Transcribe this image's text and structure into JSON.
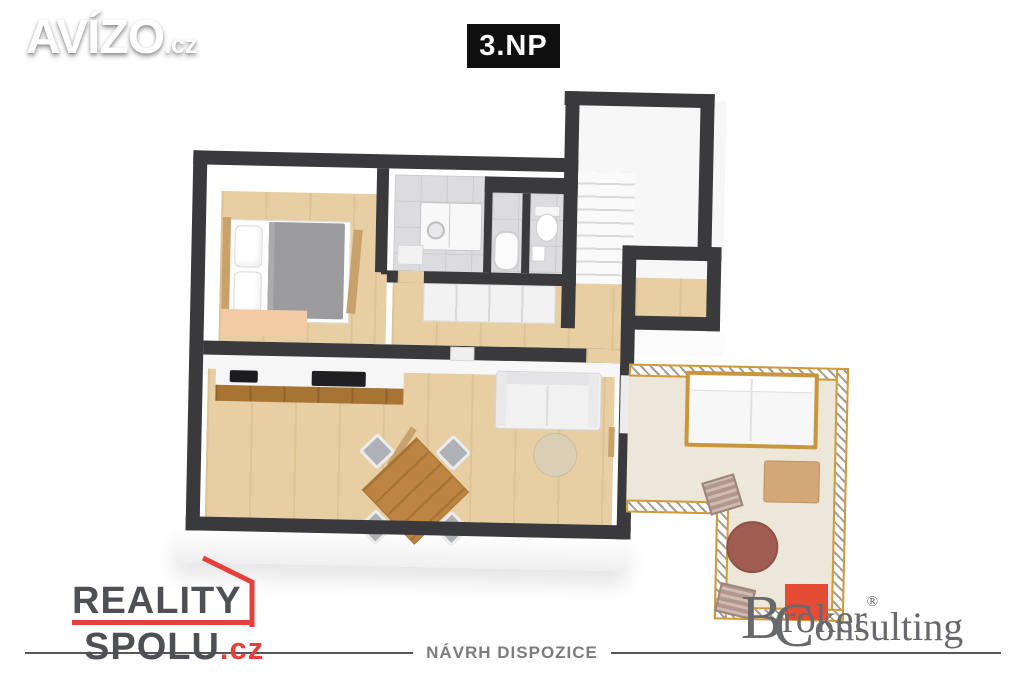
{
  "header": {
    "brand": {
      "name": "AVÍZO",
      "tld": ".cz"
    },
    "floor_badge": "3.NP"
  },
  "footer": {
    "agency": {
      "line1": "REALITY",
      "line2": "SPOLU",
      "tld": ".cz"
    },
    "caption": "NÁVRH DISPOZICE",
    "partner": {
      "word1_initial": "B",
      "word1_mid": "r",
      "word1_red": "ok",
      "word1_end": "er",
      "registered": "®",
      "word2_initial": "C",
      "word2_rest": "onsulting"
    }
  },
  "colors": {
    "wall": "#3a3a3d",
    "wood_floor": "#e7cfa3",
    "bathroom_tile": "#dcdcde",
    "terrace_floor": "#ede7da",
    "terrace_railing": "#cf9a3c",
    "agency_red": "#e5403a",
    "agency_gray": "#4e5054",
    "partner_red": "#e54c35",
    "partner_gray": "#68696d",
    "badge_bg": "#0f0f0f",
    "bed_blanket": "#9b9b9d",
    "outdoor_table": "#a05c50"
  }
}
